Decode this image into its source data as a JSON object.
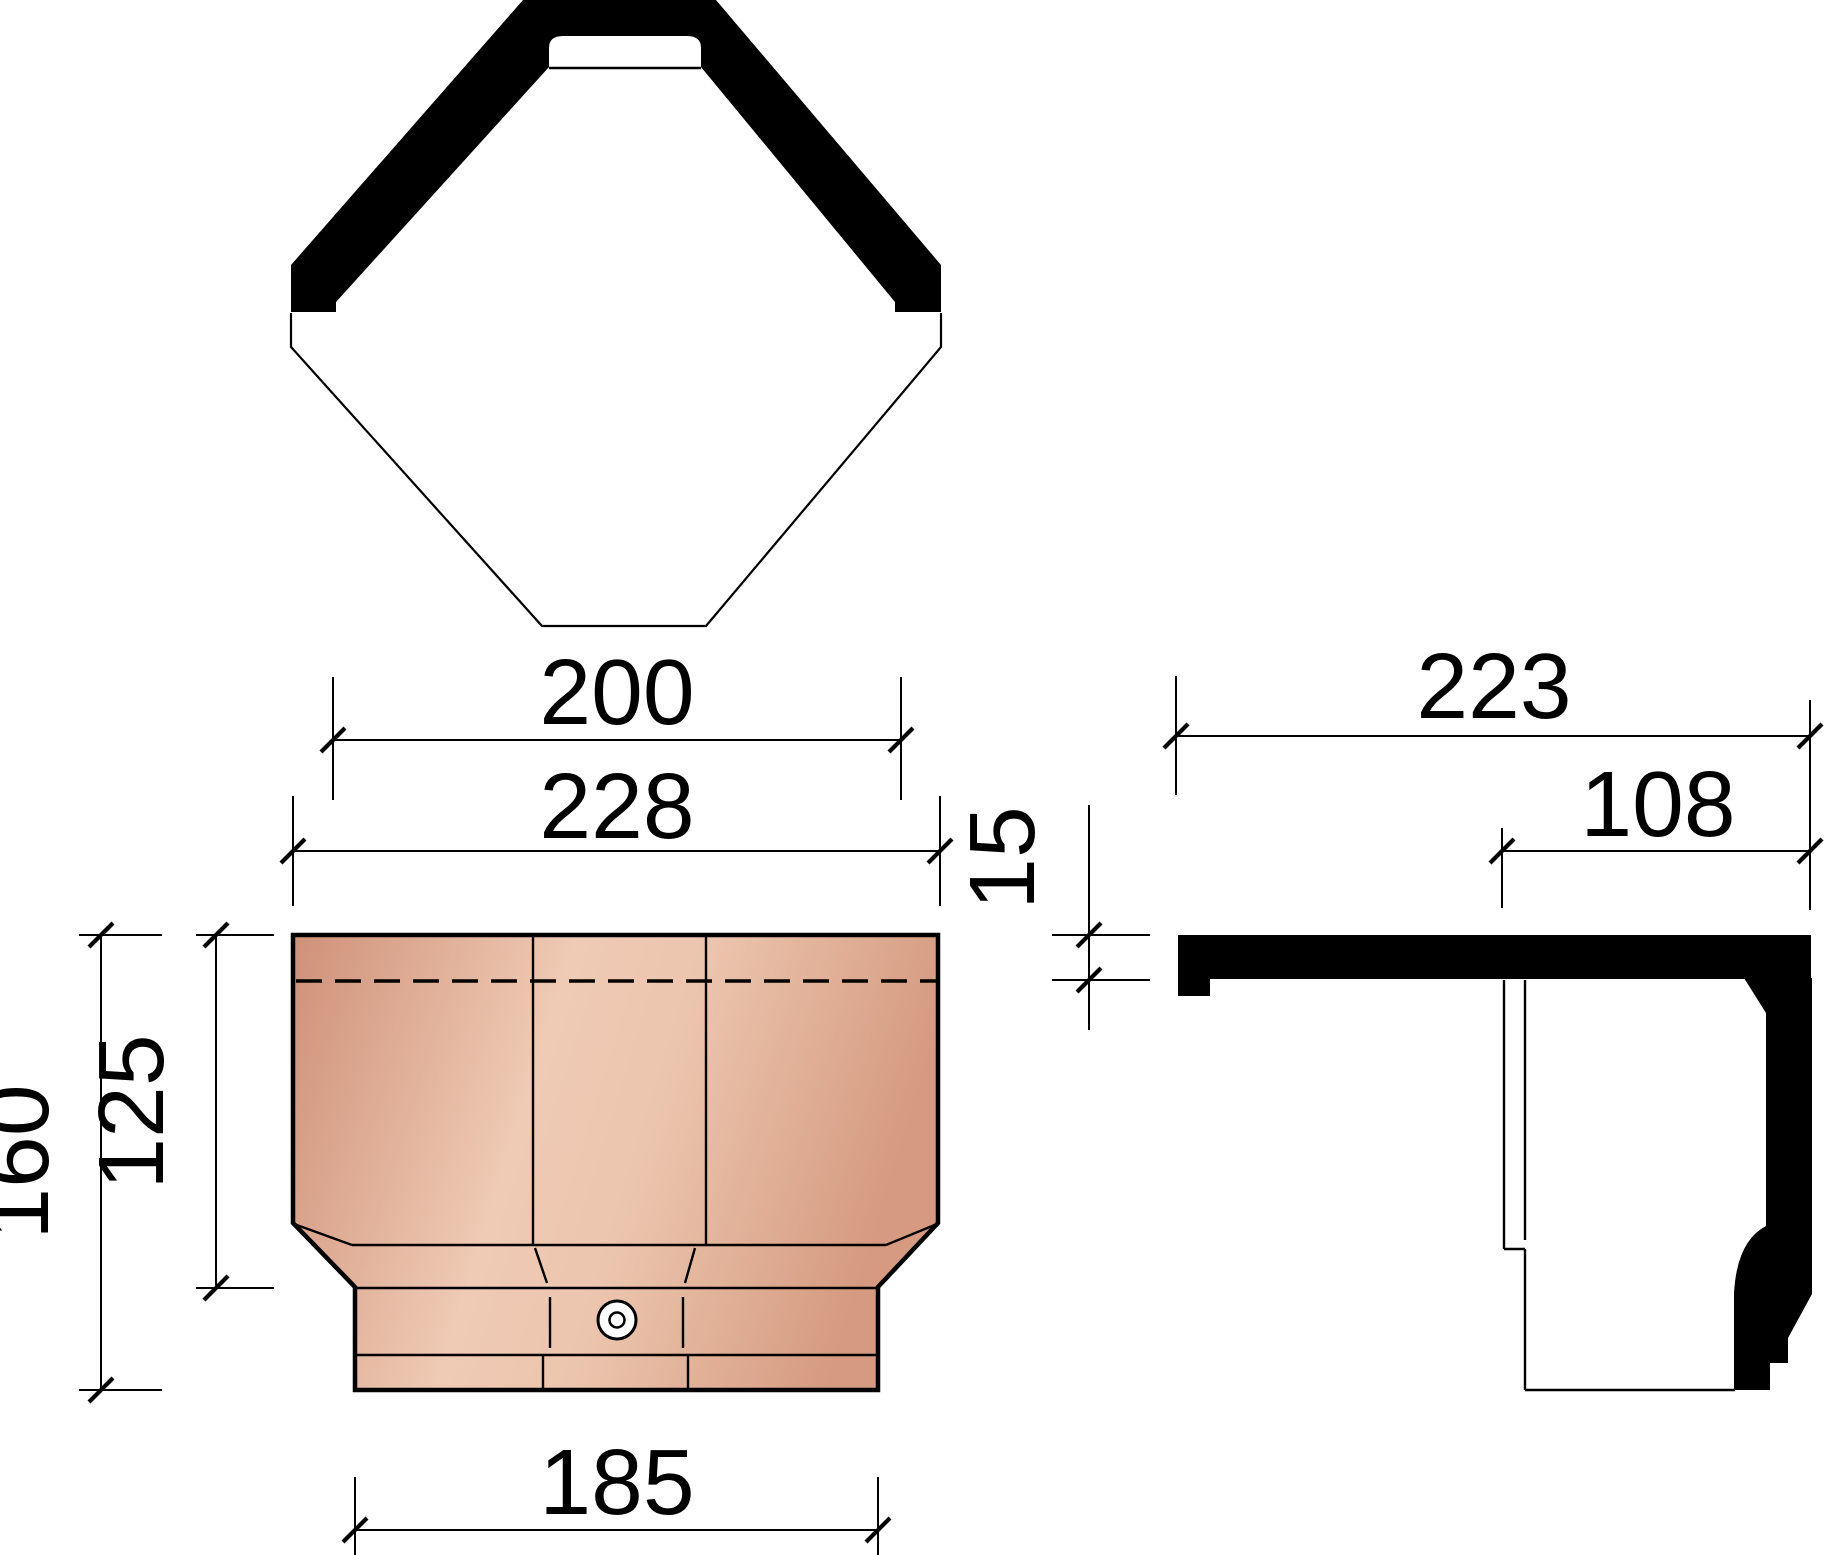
{
  "drawing": {
    "background": "#ffffff",
    "line_color": "#000000",
    "tile_colors": {
      "edge_dark": "#cf9078",
      "light_mid": "#efcab4",
      "light_right": "#ecc5ae",
      "dark_right": "#d59a80",
      "hole_fill": "#ffffff"
    },
    "dimensions": {
      "top_width_inner": "200",
      "top_width_outer": "228",
      "front_height_total": "160",
      "front_height_upper": "125",
      "front_width_bottom": "185",
      "side_width_total": "223",
      "side_width_right": "108",
      "side_thickness": "15"
    }
  }
}
